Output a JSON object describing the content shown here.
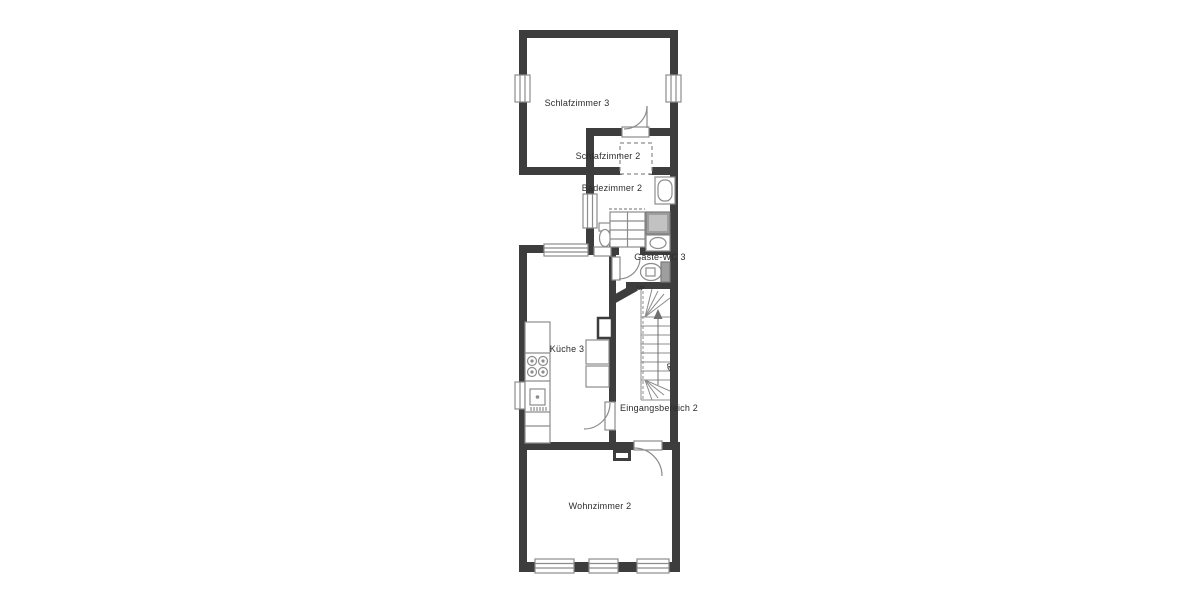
{
  "floorplan": {
    "rooms": {
      "bedroom3": {
        "label": "Schlafzimmer 3"
      },
      "bedroom2": {
        "label": "Schlafzimmer 2"
      },
      "bathroom2": {
        "label": "Badezimmer 2"
      },
      "guest_wc": {
        "label": "Gäste-WC 3"
      },
      "kitchen": {
        "label": "Küche 3"
      },
      "entrance": {
        "label": "Eingangsbereich 2"
      },
      "living_room": {
        "label": "Wohnzimmer 2"
      }
    },
    "stairs": {
      "label_top": "UP",
      "label_bottom": "UP"
    },
    "colors": {
      "wall": "#3d3d3d",
      "fixture_line": "#8c8c8c",
      "fixture_dark": "#9e9e9e",
      "text": "#2d2d2d",
      "background": "#ffffff"
    }
  }
}
